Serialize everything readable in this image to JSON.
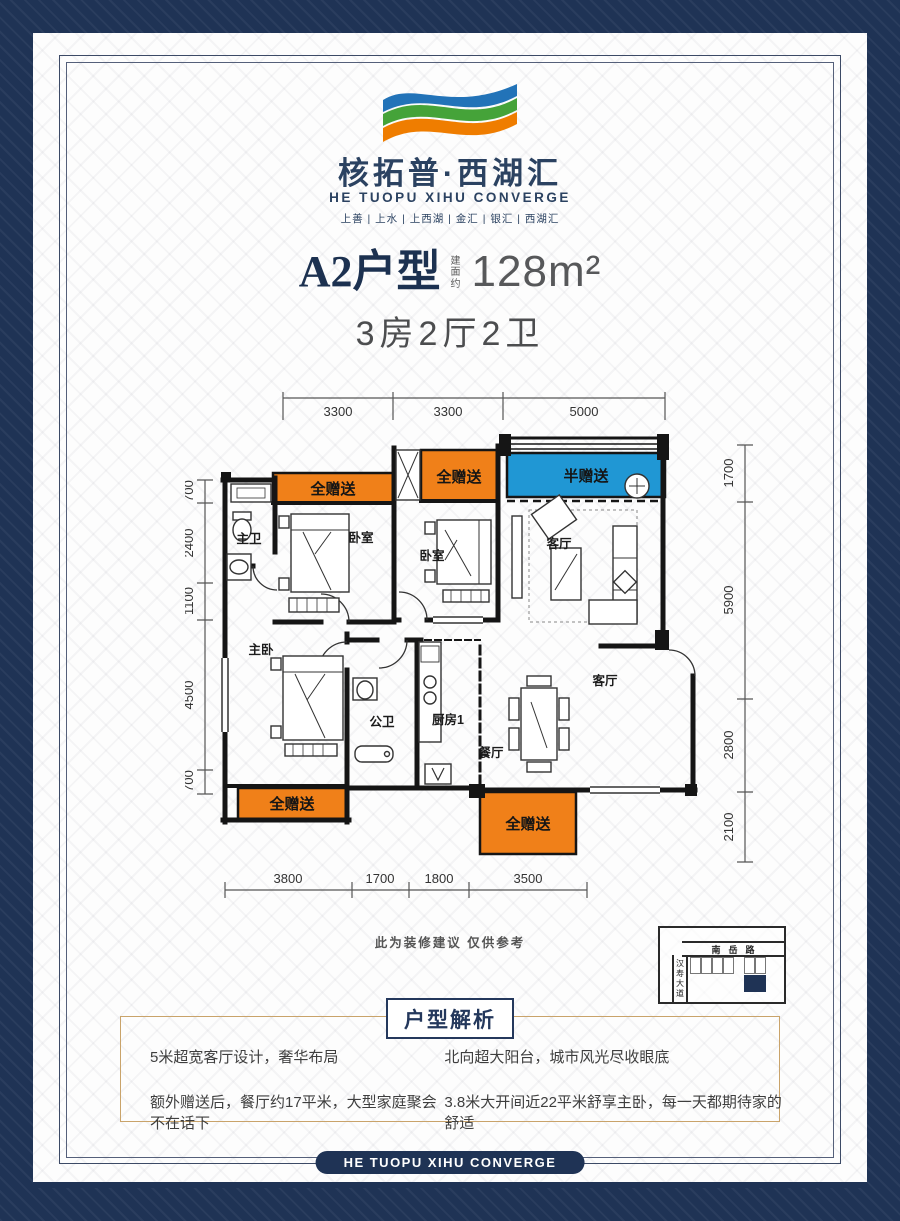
{
  "brand": {
    "name_cn": "核拓普·西湖汇",
    "name_en": "HE TUOPU XIHU CONVERGE",
    "sub_brands": "上善 | 上水 | 上西湖 | 金汇 | 银汇 | 西湖汇"
  },
  "title": {
    "unit": "A2户型",
    "area_prefix": "建面约",
    "area": "128m²",
    "layout": "3房2厅2卫"
  },
  "plan": {
    "dims": {
      "top": [
        "3300",
        "3300",
        "5000"
      ],
      "left": [
        "700",
        "2400",
        "1100",
        "4500",
        "700"
      ],
      "right": [
        "1700",
        "5900",
        "2800",
        "2100"
      ],
      "bottom": [
        "3800",
        "1700",
        "1800",
        "3500"
      ]
    },
    "zones": {
      "full_gift_1": "全赠送",
      "full_gift_2": "全赠送",
      "half_gift": "半赠送",
      "full_gift_3": "全赠送",
      "full_gift_4": "全赠送"
    },
    "rooms": {
      "master_bath": "主卫",
      "bedroom1": "卧室",
      "bedroom2": "卧室",
      "living1": "客厅",
      "master_bedroom": "主卧",
      "public_bath": "公卫",
      "kitchen": "厨房1",
      "dining": "餐厅",
      "living2": "客厅"
    },
    "note": "此为装修建议 仅供参考"
  },
  "map": {
    "road_top": "南岳路",
    "road_left": "汉寿大道"
  },
  "analysis": {
    "header": "户型解析",
    "points": [
      "5米超宽客厅设计，奢华布局",
      "北向超大阳台，城市风光尽收眼底",
      "额外赠送后，餐厅约17平米，大型家庭聚会不在话下",
      "3.8米大开间近22平米舒享主卧，每一天都期待家的舒适"
    ]
  },
  "footer": {
    "badge": "HE TUOPU XIHU CONVERGE"
  },
  "colors": {
    "navy": "#1f3355",
    "orange": "#f08019",
    "blue": "#2097d4",
    "gold": "#c9a36a"
  }
}
